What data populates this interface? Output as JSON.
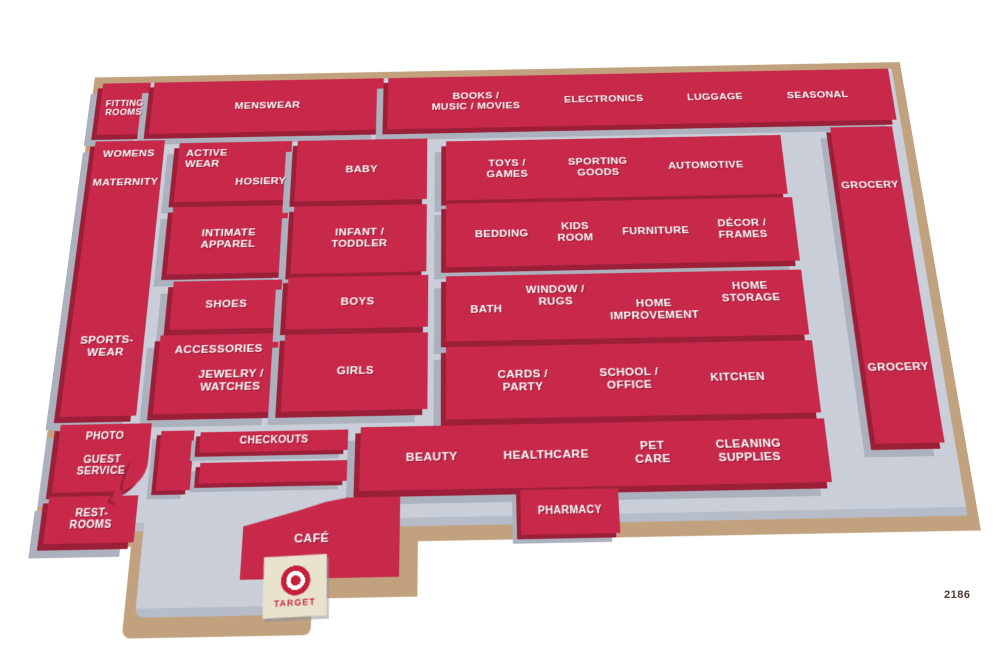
{
  "map": {
    "title": "Target store floor plan",
    "store_number": "2186",
    "logo_text": "TARGET",
    "colors": {
      "department_red": "#C8294B",
      "department_side_red": "#9B1F38",
      "floor_gray": "#C9CED8",
      "platform_tan": "#C2A17F",
      "sign_cream": "#E9E3CE",
      "logo_red": "#C51F39",
      "label_text": "#FFFFFF"
    },
    "departments": {
      "fitting_rooms": "FITTING\nROOMS",
      "menswear": "MENSWEAR",
      "books_music_movies": "BOOKS /\nMUSIC / MOVIES",
      "electronics": "ELECTRONICS",
      "luggage": "LUGGAGE",
      "seasonal": "SEASONAL",
      "womens": "WOMENS",
      "maternity": "MATERNITY",
      "sportswear": "SPORTS-\nWEAR",
      "active_wear": "ACTIVE\nWEAR",
      "hosiery": "HOSIERY",
      "intimate_apparel": "INTIMATE\nAPPAREL",
      "baby": "BABY",
      "infant_toddler": "INFANT /\nTODDLER",
      "toys_games": "TOYS /\nGAMES",
      "sporting_goods": "SPORTING\nGOODS",
      "automotive": "AUTOMOTIVE",
      "bedding": "BEDDING",
      "kids_room": "KIDS\nROOM",
      "furniture": "FURNITURE",
      "decor_frames": "DÉCOR /\nFRAMES",
      "grocery_1": "GROCERY",
      "grocery_2": "GROCERY",
      "shoes": "SHOES",
      "accessories": "ACCESSORIES",
      "jewelry_watches": "JEWELRY /\nWATCHES",
      "boys": "BOYS",
      "girls": "GIRLS",
      "bath": "BATH",
      "window_rugs": "WINDOW /\nRUGS",
      "home_improvement": "HOME\nIMPROVEMENT",
      "home_storage": "HOME\nSTORAGE",
      "cards_party": "CARDS /\nPARTY",
      "school_office": "SCHOOL /\nOFFICE",
      "kitchen": "KITCHEN",
      "checkouts": "CHECKOUTS",
      "beauty": "BEAUTY",
      "healthcare": "HEALTHCARE",
      "pet_care": "PET\nCARE",
      "cleaning_supplies": "CLEANING\nSUPPLIES",
      "pharmacy": "PHARMACY",
      "photo": "PHOTO",
      "guest_service": "GUEST\nSERVICE",
      "restrooms": "REST-\nROOMS",
      "cafe": "CAFÉ"
    }
  }
}
